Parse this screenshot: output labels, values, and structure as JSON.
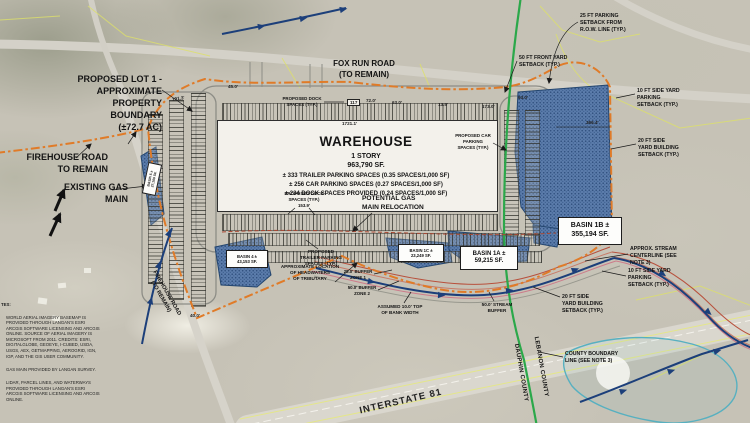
{
  "building": {
    "name": "WAREHOUSE",
    "story": "1 STORY",
    "area": "963,790 SF.",
    "stat_trailer": "± 333 TRAILER PARKING SPACES (0.35 SPACES/1,000 SF)",
    "stat_car": "± 256 CAR PARKING SPACES (0.27 SPACES/1,000 SF)",
    "stat_dock": "± 234 DOCK SPACES PROVIDED (0.24 SPACES/1,000 SF)"
  },
  "callouts": {
    "proposed_lot": "PROPOSED LOT 1 -\nAPPROXIMATE\nPROPERTY\nBOUNDARY\n(±72.7 AC)",
    "firehouse_road": "FIREHOUSE ROAD\nTO REMAIN",
    "existing_gas": "EXISTING GAS\nMAIN",
    "fox_run_road": "FOX RUN ROAD\n(TO REMAIN)",
    "setback_25_parking": "25 FT PARKING\nSETBACK FROM\nR.O.W. LINE (TYP.)",
    "setback_50_front": "50 FT FRONT YARD\nSETBACK (TYP.)",
    "setback_10_side_top": "10 FT SIDE YARD\nPARKING\nSETBACK (TYP.)",
    "setback_20_side_right": "20 FT SIDE\nYARD BUILDING\nSETBACK (TYP.)",
    "stream_centerline": "APPROX. STREAM\nCENTERLINE (SEE\nNOTE 3)",
    "setback_10_side_lower": "10 FT SIDE YARD\nPARKING\nSETBACK (TYP.)",
    "setback_20_side_lower": "20 FT SIDE\nYARD BUILDING\nSETBACK (TYP.)",
    "county_boundary": "COUNTY BOUNDARY\nLINE (SEE NOTE 3)",
    "dauphin": "DAUPHIN COUNTY",
    "lebanon": "LEBANON COUNTY",
    "interstate": "INTERSTATE 81",
    "trailer_spaces": "PROPOSED\nTRAILER PARKING\nSPACES (TYP.)",
    "headwaters": "APPROXIMATE LOCATION\nOF HEADWATERS\nOF TRIBUTARY",
    "buffer_zone_1": "25.0' BUFFER\nZONE 1",
    "buffer_zone_2": "50.0' BUFFER\nZONE 2",
    "top_of_bank": "ASSUMED 10.0' TOP\nOF BANK WIDTH",
    "stream_buffer": "50.0' STREAM\nBUFFER",
    "dock_spaces_road": "PROPOSED DOCK\nSPACES (TYP.)",
    "dock_spaces_inner": "PROPOSED DOCK\nSPACES (TYP.)\n153.9'",
    "car_spaces": "PROPOSED CAR\nPARKING\nSPACES (TYP.)",
    "potential_gas": "POTENTIAL GAS\nMAIN RELOCATION",
    "firehouse_road_rotated": "FIREHOUSE ROAD\n(TO REMAIN)"
  },
  "basins": {
    "b1b": "BASIN 1B ±\n355,194 SF.",
    "b1a": "BASIN 1A ±\n59,215 SF.",
    "b1c": "BASIN 1C ±\n23,249 SF.",
    "b4": "BASIN 4 ±\n43,153 SF.",
    "b5": "BASIN 5 ±\n27,100 SF."
  },
  "dimensions": {
    "d1721": "1721.1'",
    "d45": "45.0'",
    "d191": "191.3'",
    "d72": "72.0'",
    "d63": "63.0'",
    "d135": "13.5'",
    "d173": "173.0'",
    "d93": "93.0'",
    "d366": "366.4'",
    "d40": "40.0'",
    "d117": "117"
  },
  "notes": {
    "header": "TES:",
    "n1": "WORLD AERIAL IMAGERY BASEMAP IS PROVIDED THROUGH LANGAN'S ESRI ARCGIS SOFTWARE LICENSING AND ARCGIS ONLINE. SOURCE OF AERIAL IMAGERY IS MICROSOFT FROM 2011. CREDITS: ESRI, DIGITALGLOBE, GEOEYE, I-CUBED, USDA, USGS, AEX, GETMAPPING, AEROGRID, IGN, IGP, AND THE GIS USER COMMUNITY.",
    "n2": "GAS MAIN PROVIDED BY LANGAN SURVEY.",
    "n3": "LIDAR, PARCEL LINES, AND WATERWAYS PROVIDED THROUGH LANGAN'S ESRI ARCGIS SOFTWARE LICENSING AND ARCGIS ONLINE."
  },
  "colors": {
    "boundary": "#e07b28",
    "county_line": "#2ba84a",
    "basin_fill": "#5b7cab",
    "stream": "#1c3f7a",
    "teal": "#57b0c0"
  }
}
